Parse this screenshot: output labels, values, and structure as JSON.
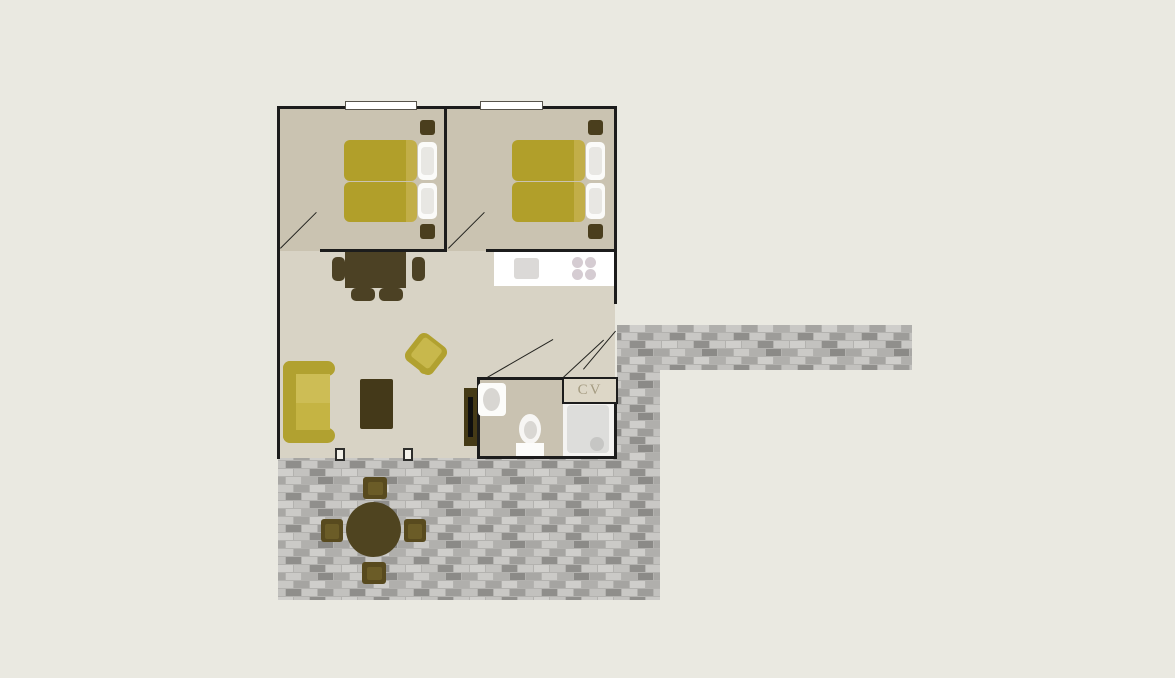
{
  "plan": {
    "type": "holiday-home-floor-plan",
    "labels": {
      "cv_closet": "CV"
    },
    "rooms": [
      {
        "name": "bedroom-1",
        "furniture": [
          "double-bed",
          "nightstand",
          "nightstand"
        ],
        "window": true,
        "door": "swing-into-room"
      },
      {
        "name": "bedroom-2",
        "furniture": [
          "double-bed",
          "nightstand",
          "nightstand"
        ],
        "window": true,
        "door": "swing-into-room"
      },
      {
        "name": "living-room",
        "furniture": [
          "dining-table-with-4-chairs",
          "sofa",
          "armchair",
          "coffee-table",
          "tv-cabinet"
        ],
        "openings": [
          "terrace-posts",
          "entrance-door"
        ]
      },
      {
        "name": "kitchen",
        "furniture": [
          "counter",
          "sink",
          "stove-4-burners"
        ]
      },
      {
        "name": "bathroom",
        "furniture": [
          "washbasin",
          "toilet",
          "shower"
        ]
      },
      {
        "name": "cv-closet",
        "label": "CV"
      },
      {
        "name": "terrace",
        "furniture": [
          "round-table",
          "chair",
          "chair",
          "chair",
          "chair"
        ]
      },
      {
        "name": "walkway",
        "furniture": []
      }
    ],
    "colors": {
      "background": "#eae9e1",
      "bedroom_floor": "#cac3b1",
      "living_floor": "#d8d3c5",
      "bathroom_floor": "#c9c2b1",
      "wall": "#1c1c1c",
      "furniture_dark": "#4c4124",
      "bed_duvet": "#b19f2a",
      "upholstery_frame": "#b1a130",
      "upholstery_cushion": "#cdbd55",
      "kitchen_counter": "#ffffff",
      "paving_base": "#b3b2af",
      "cv_text": "#a59c82"
    }
  }
}
